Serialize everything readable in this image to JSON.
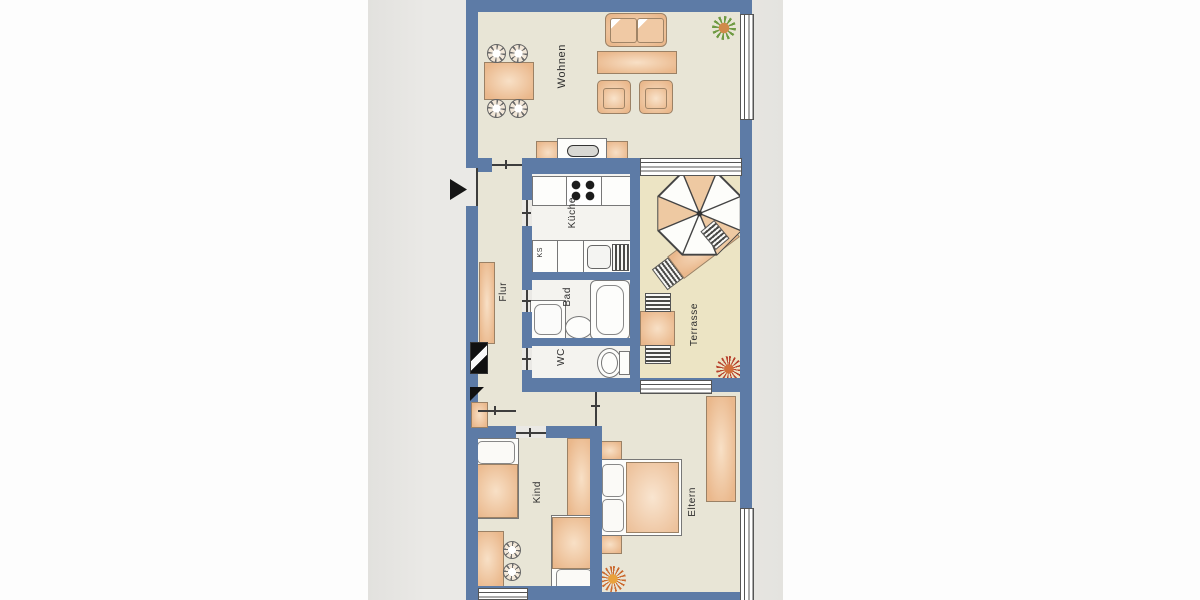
{
  "labels": {
    "wohnen": "Wohnen",
    "kueche": "Küche",
    "ks": "KS",
    "bad": "Bad",
    "wc": "WC",
    "flur": "Flur",
    "terrasse": "Terrasse",
    "kind": "Kind",
    "eltern": "Eltern"
  },
  "colors": {
    "wall": "#5d7ba6",
    "room_floor": "#e8e5d6",
    "wet_room_floor": "#f4f3ef",
    "terrace_floor": "#ece4c4",
    "furniture_wood": "#eab88c",
    "paper": "#e8e7e4",
    "plant_green": "#6f9b43",
    "plant_red": "#b8432e"
  }
}
